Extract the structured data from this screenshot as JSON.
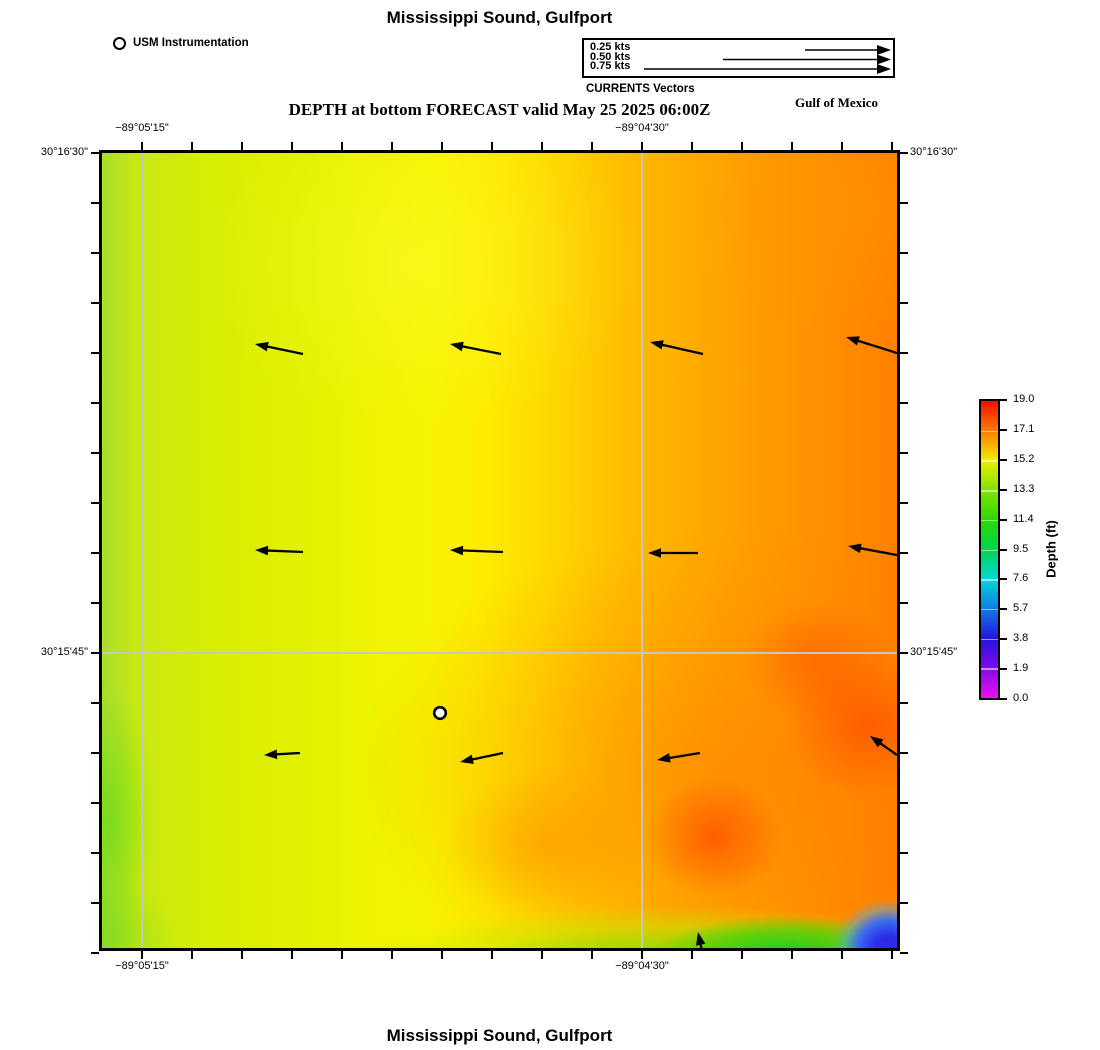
{
  "titles": {
    "top": "Mississippi Sound, Gulfport",
    "subtitle": "DEPTH at bottom FORECAST valid May 25 2025 06:00Z",
    "bottom": "Mississippi Sound, Gulfport",
    "region_label": "Gulf of Mexico"
  },
  "usm": {
    "label": "USM Instrumentation"
  },
  "vector_legend": {
    "title": "CURRENTS Vectors",
    "entries": [
      {
        "label": "0.25 kts",
        "x_start": 221,
        "y": 10
      },
      {
        "label": "0.50 kts",
        "x_start": 139,
        "y": 19.5
      },
      {
        "label": "0.75 kts",
        "x_start": 60,
        "y": 29
      }
    ],
    "arrow_tip_x": 307,
    "label_row_tops": [
      3,
      12.5,
      22
    ]
  },
  "colorbar": {
    "label": "Depth (ft)",
    "ticks": [
      "19.0",
      "17.1",
      "15.2",
      "13.3",
      "11.4",
      "9.5",
      "7.6",
      "5.7",
      "3.8",
      "1.9",
      "0.0"
    ],
    "gradient_top_to_bottom": [
      "#f70b00",
      "#ff7c00",
      "#eded00",
      "#7fe400",
      "#2ed900",
      "#00d54d",
      "#00d9d9",
      "#0f7ce8",
      "#2414e0",
      "#8009e8",
      "#ef0fef"
    ]
  },
  "chart_data": {
    "type": "heatmap",
    "title": "Mississippi Sound, Gulfport",
    "subtitle": "DEPTH at bottom FORECAST valid May 25 2025 06:00Z",
    "colorbar": {
      "label": "Depth (ft)",
      "min": 0.0,
      "max": 19.0,
      "tick_step": 1.9,
      "tick_values": [
        19.0,
        17.1,
        15.2,
        13.3,
        11.4,
        9.5,
        7.6,
        5.7,
        3.8,
        1.9,
        0.0
      ]
    },
    "x_axis": {
      "labeled_ticks": [
        {
          "text": "−89°05'15\"",
          "px": 40
        },
        {
          "text": "−89°04'30\"",
          "px": 540
        }
      ],
      "gridlines_px": [
        40,
        540
      ],
      "minor_tick_start_px": 40,
      "minor_tick_step_px": 50,
      "minor_tick_count": 16
    },
    "y_axis": {
      "labeled_ticks": [
        {
          "text": "30°16'30\"",
          "px": 0
        },
        {
          "text": "30°15'45\"",
          "px": 500
        }
      ],
      "gridlines_px": [
        500
      ],
      "minor_tick_start_px": 0,
      "minor_tick_step_px": 50,
      "minor_tick_count": 17
    },
    "depth_field_summary": {
      "west": "≈13–15 ft (yellow-green)",
      "center": "≈15–16 ft (yellow)",
      "east": "≈17–19 ft (orange to red-orange)",
      "south_band": "≈9–13 ft (green band along southern edge, east half)",
      "southeast_corner": "≈2–6 ft (blue patch)"
    },
    "current_vectors": {
      "direction": "westward (toward upper-left); small vector near south edge points north",
      "speed_est_kts": 0.15,
      "arrows_map_px": [
        {
          "tail": [
            201,
            201
          ],
          "tip": [
            153,
            191
          ]
        },
        {
          "tail": [
            399,
            201
          ],
          "tip": [
            348,
            191
          ]
        },
        {
          "tail": [
            601,
            201
          ],
          "tip": [
            548,
            189
          ]
        },
        {
          "tail": [
            798,
            201
          ],
          "tip": [
            744,
            184
          ]
        },
        {
          "tail": [
            201,
            399
          ],
          "tip": [
            153,
            397
          ]
        },
        {
          "tail": [
            401,
            399
          ],
          "tip": [
            348,
            397
          ]
        },
        {
          "tail": [
            596,
            400
          ],
          "tip": [
            546,
            400
          ]
        },
        {
          "tail": [
            795,
            402
          ],
          "tip": [
            746,
            393
          ]
        },
        {
          "tail": [
            198,
            600
          ],
          "tip": [
            162,
            602
          ]
        },
        {
          "tail": [
            401,
            600
          ],
          "tip": [
            358,
            609
          ]
        },
        {
          "tail": [
            598,
            600
          ],
          "tip": [
            555,
            607
          ]
        },
        {
          "tail": [
            795,
            602
          ],
          "tip": [
            768,
            583
          ]
        },
        {
          "tail": [
            600,
            798
          ],
          "tip": [
            596,
            779
          ]
        }
      ]
    },
    "instrument_marker_map_px": [
      338,
      560
    ],
    "grid_color": "#c6c6c2"
  }
}
